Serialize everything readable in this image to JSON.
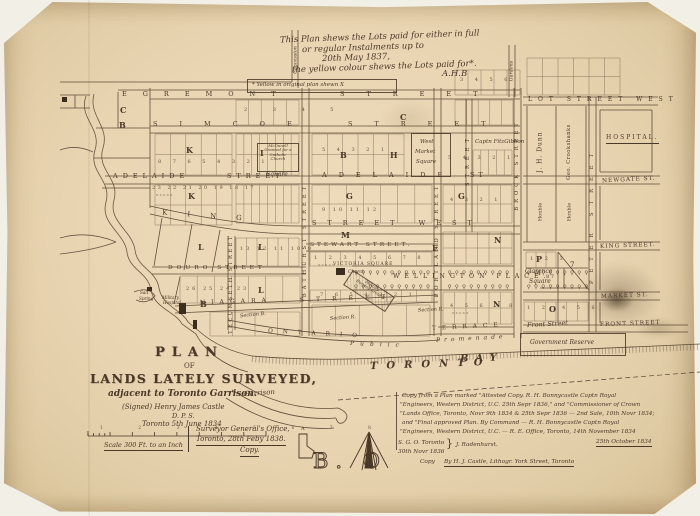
{
  "top_note": {
    "l1": "This Plan shews the Lots paid for either in full",
    "l2": "or regular Instalments up to",
    "l3": "20th May 1837,",
    "l4": "the yellow colour shews the Lots paid for*.",
    "initials": "A.H.B",
    "footnote": "* Yellow in original plan shewn  X"
  },
  "streets": {
    "egremont": "EGREMONT",
    "egremont_street": "STREET",
    "simcoe": "SIMCOE",
    "simcoe_street": "STREET",
    "adelaide_w": "ADELAIDE",
    "adelaide_w_street": "STREET",
    "adelaide_e": "ADELAIDE",
    "adelaide_e_street": "ST",
    "king_w": "KING",
    "king_center": "STREET WEST",
    "stewart": "STEWART STREET.",
    "douro": "DOURO STREET",
    "niagara": "NIAGARA",
    "niagara_street": "STREET",
    "wellington": "WELLINGTON  PLACE.",
    "tecumseth": "TECUMSETH STREET",
    "bathurst": "BATHURST STREET",
    "portland": "PORTLAND STREET",
    "brock": "BROCK STREET",
    "mid_street": "STREET",
    "peter": "PETER STREET",
    "lot_west": "LOT  STREET  WEST",
    "newgate": "NEWGATE  ST.",
    "king_e": "KING  STREET.",
    "market": "MARKET  ST.",
    "front_e": "FRONT  STREET",
    "front_script": "Front Street",
    "ontario": "ONTARIO",
    "terrace": "TERRACE",
    "public": "Public",
    "promenade": "Promenade",
    "concession": "Concession",
    "gardens": "Gardens"
  },
  "places": {
    "west_market": {
      "l1": "West",
      "l2": "Market",
      "l3": "Square"
    },
    "fitzgibbon": "Captn FitzGibbon",
    "victoria": "VICTORIA SQUARE",
    "church": "Church",
    "burying": {
      "l1": "Military",
      "l2": "Burying Ground"
    },
    "mcdonell": {
      "l1": "McDonell",
      "l2": "Granted for a",
      "l3": "Catholic",
      "l4": "Church"
    },
    "square_small": "Square",
    "clarence": {
      "l1": "Clarence",
      "l2": "Square"
    },
    "government": "Government Reserve",
    "garrison": "Garrison",
    "toronto": "TORONTO",
    "bay": "BAY",
    "dunn": "J. H. Dunn",
    "crookshanks": "Geo. Crookshanks",
    "hon1": "Honble",
    "hon2": "Honble",
    "hospital": "HOSPITAL.",
    "salt1": "Salt",
    "salt2": "Spring",
    "mil1": "Military",
    "mil2": "Hospital",
    "section_b": "Section B.",
    "section_r1": "Section R.",
    "section_r2": "Section R."
  },
  "letters": {
    "c1": "C",
    "b1": "B",
    "k1": "K",
    "k2": "K",
    "l1": "L",
    "l2": "L",
    "l3": "L",
    "b2": "B",
    "h1": "H",
    "c2": "C",
    "g1": "G",
    "g2": "G",
    "m1": "M",
    "f1": "F",
    "n1": "N",
    "n2": "N",
    "p1": "P",
    "o1": "O",
    "i1": "I",
    "b3": "B",
    "seven": "7",
    "four": "4",
    "eight_seven": "8  7",
    "a1": "A"
  },
  "numbers": {
    "a": "2 3 4 5",
    "b": "8 7 6 5 4 3 2 1",
    "c": "23 22 21 20 19 18 17",
    "d": "5 4 3 2 1",
    "e": "9 10 11 12",
    "f": "5 4 3 2 1",
    "g": "4 3 2 1",
    "h": "1 2 3 4 5 6 7 8",
    "i": "7 6 5 4 3 2 1",
    "j": "4 5 6 7 8",
    "k": "1 2 3",
    "l": "1 2",
    "m": "4 5 6",
    "n": "3 4 5 6",
    "o": "13 12 11 10 9",
    "p": "26 25 24 23",
    "xs": "x   x   x   x   x",
    "scale_nums": "1  2  3  4  5  6  7  8"
  },
  "title": {
    "plan": "PLAN",
    "of": "OF",
    "main": "LANDS LATELY SURVEYED,",
    "sub": "adjacent to Toronto Garrison.",
    "signed": "(Signed) Henry James Castle",
    "dps": "D. P. S.",
    "date": "Toronto 5th June 1834"
  },
  "scale_label": "Scale 300 Ft. to an Inch",
  "sgo": {
    "l1": "Surveyor General's Office,",
    "l2": "Toronto, 28th Feby 1838.",
    "l3": "Copy."
  },
  "attestation": {
    "l1": "Copy from a Plan marked \"Attested Copy.  R. H. Bonnycastle Captn Royal",
    "l2": "\"Engineers, Western District, U.C. 25th Sepr 1836,\" and \"Commissioner of Crown",
    "l3": "\"Lands Office, Toronto, Novr 9th 1834 & 25th Sepr 1836 — 2nd Sale, 10th Novr 1834;",
    "l4": "and \"Final approved Plan.  By Command — R. H. Bonnycastle Captn Royal",
    "l5": "\"Engineers, Western District, U.C. —   R. E. Office, Toronto, 14th November 1834",
    "sgo1": "S. G. O. Toronto",
    "sgo2": "30th Novr 1836",
    "name": "J. Radenhurst.",
    "date": "25th October 1834",
    "copy": "Copy",
    "by": "By H. J. Castle, Lithogr. York Street, Toronto"
  },
  "compass_letters": "B. O"
}
